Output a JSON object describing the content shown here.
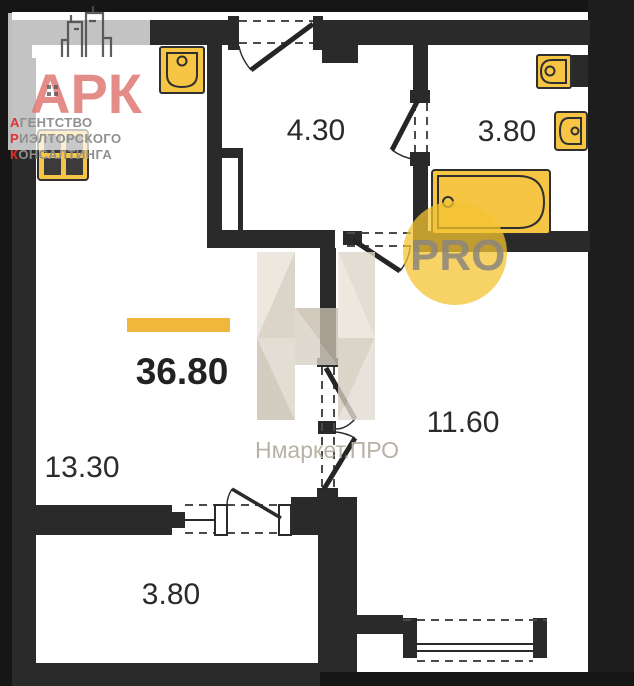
{
  "plan": {
    "type": "apartment-floor-plan",
    "total_area": {
      "value": "36.80",
      "bar_color": "#f1b73c"
    },
    "rooms": [
      {
        "name": "hallway",
        "area": "4.30"
      },
      {
        "name": "bathroom",
        "area": "3.80"
      },
      {
        "name": "living-kitchen",
        "area": "13.30"
      },
      {
        "name": "bedroom",
        "area": "11.60"
      },
      {
        "name": "balcony",
        "area": "3.80"
      }
    ],
    "fixtures": [
      "kitchen-sink",
      "stove",
      "bathroom-sink",
      "toilet",
      "bathtub"
    ],
    "colors": {
      "wall": "#2a2a2a",
      "frame": "#161616",
      "fixture": "#f6c544",
      "label": "#2b2b2b"
    }
  },
  "branding": {
    "agency_logo": {
      "monogram": "АРК",
      "monogram_color": "#e07a74",
      "line1": {
        "first": "А",
        "rest": "ГЕНТСТВО"
      },
      "line2": {
        "first": "Р",
        "rest": "ИЭЛТОРСКОГО"
      },
      "line3": {
        "first": "К",
        "rest": "ОНСАЛТИНГА"
      },
      "accent_color": "#e03232",
      "muted_color": "#8f8f8f"
    },
    "watermark": {
      "brand": "Нмаркет.ПРО",
      "badge": "PRO",
      "badge_circle_color": "#f4c331",
      "badge_text_color": "#8b857c",
      "letter_tone": "#d6cfc3"
    }
  }
}
